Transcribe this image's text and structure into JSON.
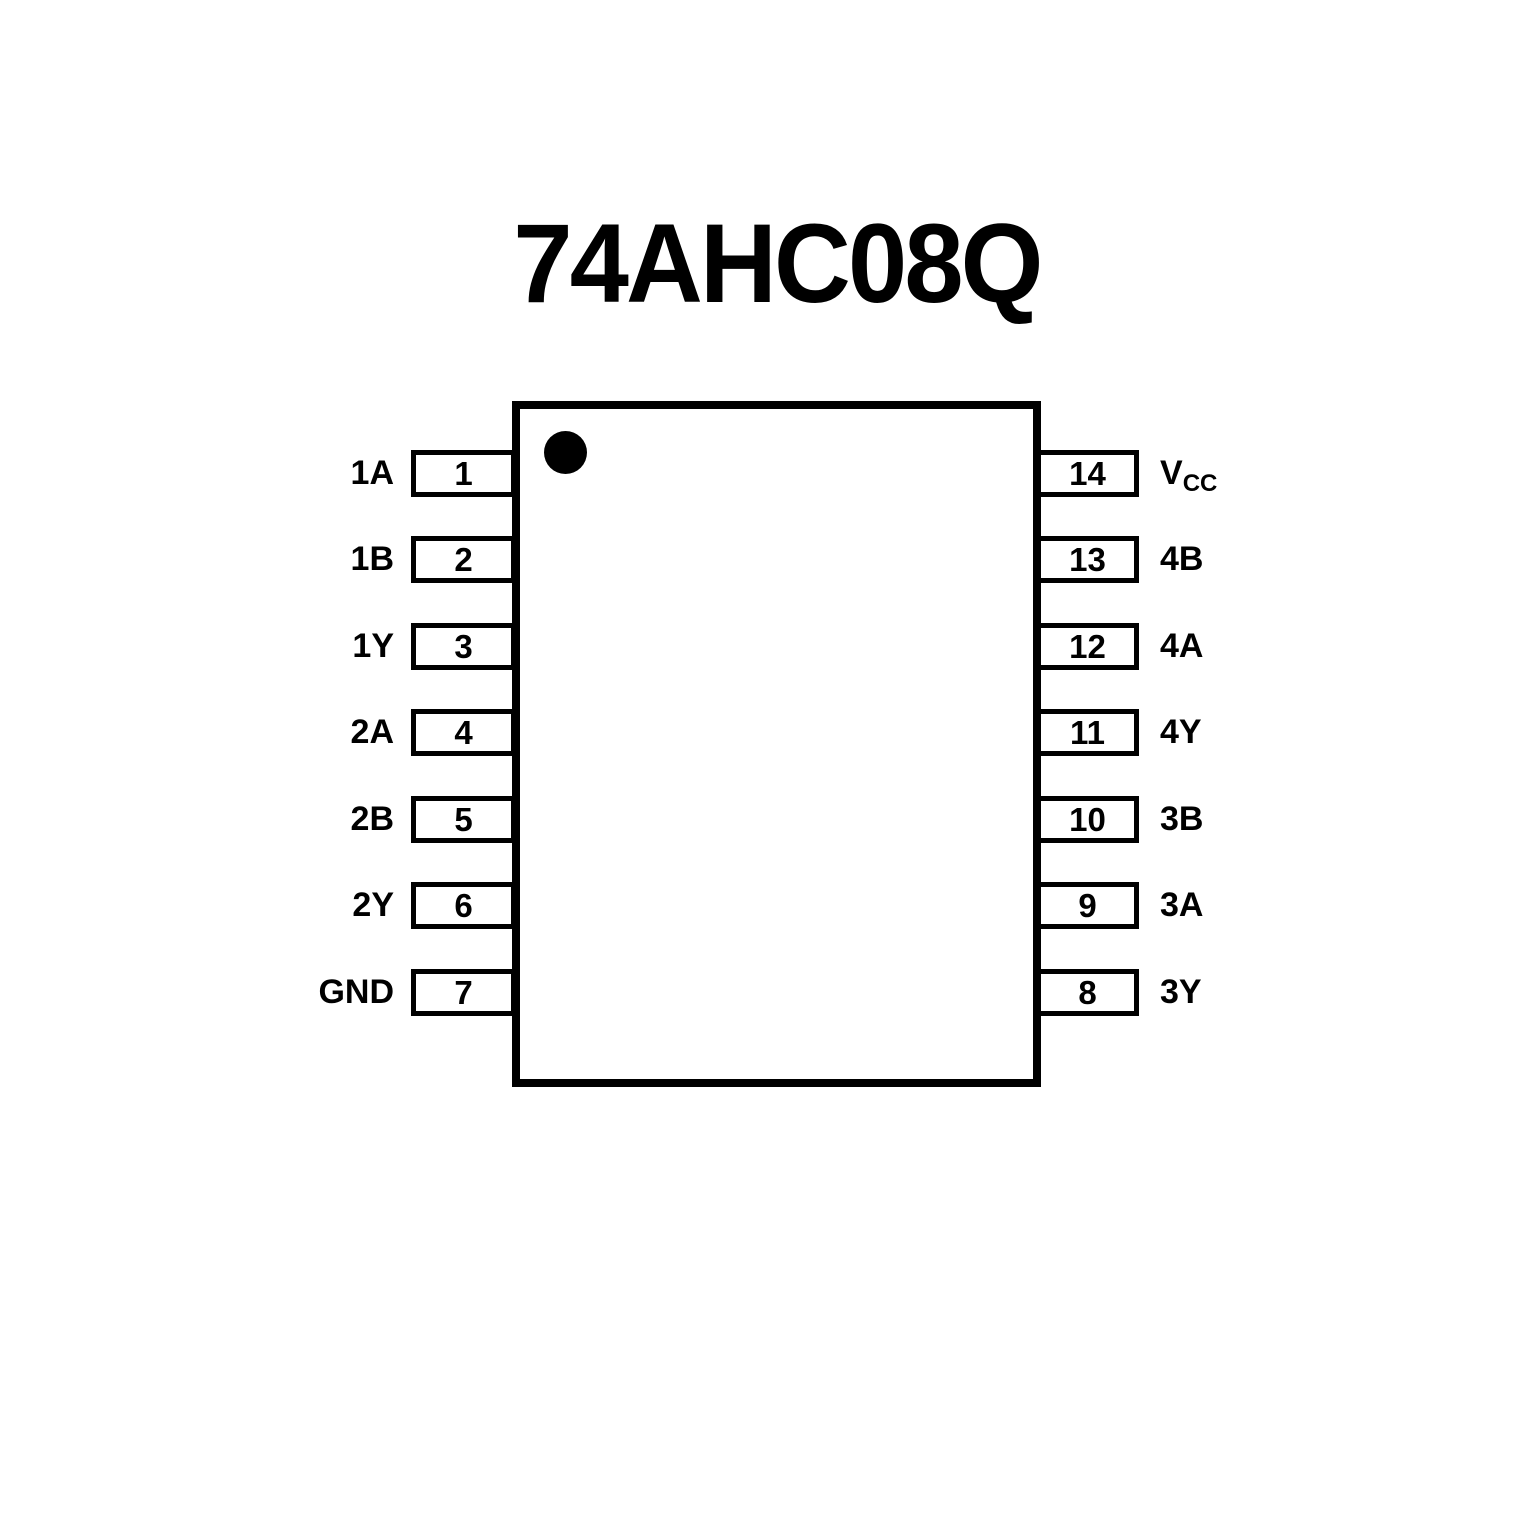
{
  "title": "74AHC08Q",
  "chip": {
    "pin1_indicator": "dot",
    "left_pins": [
      {
        "label": "1A",
        "label_sub": "",
        "number": "1"
      },
      {
        "label": "1B",
        "label_sub": "",
        "number": "2"
      },
      {
        "label": "1Y",
        "label_sub": "",
        "number": "3"
      },
      {
        "label": "2A",
        "label_sub": "",
        "number": "4"
      },
      {
        "label": "2B",
        "label_sub": "",
        "number": "5"
      },
      {
        "label": "2Y",
        "label_sub": "",
        "number": "6"
      },
      {
        "label": "GND",
        "label_sub": "",
        "number": "7"
      }
    ],
    "right_pins": [
      {
        "label": "V",
        "label_sub": "CC",
        "number": "14"
      },
      {
        "label": "4B",
        "label_sub": "",
        "number": "13"
      },
      {
        "label": "4A",
        "label_sub": "",
        "number": "12"
      },
      {
        "label": "4Y",
        "label_sub": "",
        "number": "11"
      },
      {
        "label": "3B",
        "label_sub": "",
        "number": "10"
      },
      {
        "label": "3A",
        "label_sub": "",
        "number": "9"
      },
      {
        "label": "3Y",
        "label_sub": "",
        "number": "8"
      }
    ]
  },
  "colors": {
    "ink": "#000000",
    "background": "#ffffff"
  }
}
